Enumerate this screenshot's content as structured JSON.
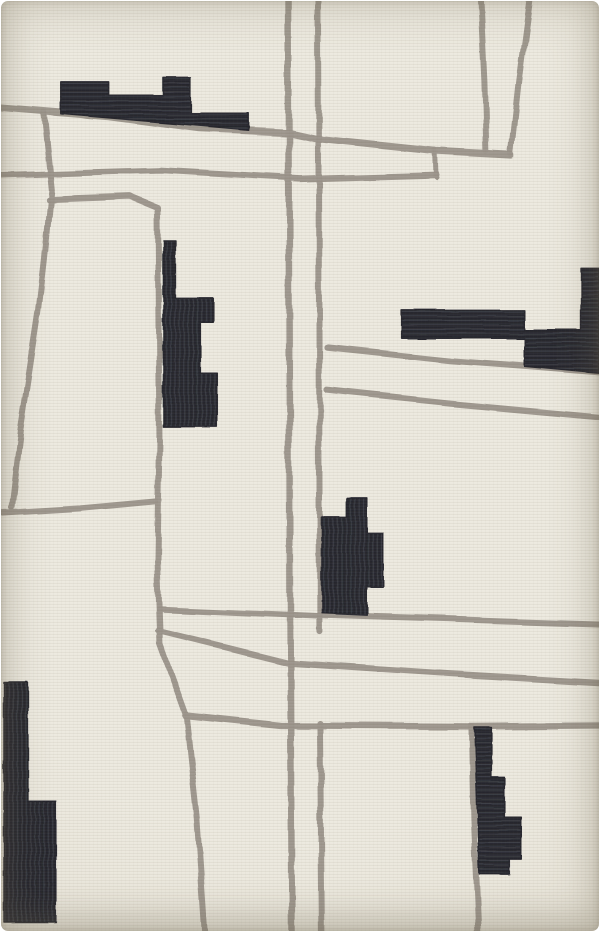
{
  "scene": {
    "type": "product-photo",
    "subject": "abstract geometric hand-tufted wool area rug",
    "style": "ivory ground crossed by hand-drawn taupe lines like an abstract street map, with charcoal stepped blocks",
    "orientation": "portrait"
  },
  "palette": {
    "page_bg": "#ffffff",
    "rug_base": "#eae7dd",
    "rug_edge": "#d5cfc0",
    "line_gray": "#9a938a",
    "block_black": "#23242b",
    "block_weave": "#363841"
  },
  "rug": {
    "lines": [
      {
        "name": "line-top-slant",
        "width": 7,
        "points": [
          [
            -3,
            107
          ],
          [
            108,
            116
          ],
          [
            200,
            128
          ],
          [
            290,
            132
          ],
          [
            322,
            139
          ],
          [
            437,
            151
          ],
          [
            512,
            155
          ]
        ]
      },
      {
        "name": "line-upper-horizontal",
        "width": 6,
        "points": [
          [
            -3,
            175
          ],
          [
            160,
            170
          ],
          [
            300,
            178
          ],
          [
            437,
            174
          ]
        ]
      },
      {
        "name": "line-upper-connector",
        "width": 5,
        "points": [
          [
            436,
            150
          ],
          [
            437,
            176
          ]
        ]
      },
      {
        "name": "line-funnel-left",
        "width": 6,
        "points": [
          [
            481,
            -3
          ],
          [
            485,
            80
          ],
          [
            487,
            151
          ]
        ]
      },
      {
        "name": "line-funnel-right",
        "width": 6,
        "points": [
          [
            531,
            -3
          ],
          [
            520,
            80
          ],
          [
            512,
            154
          ]
        ]
      },
      {
        "name": "line-center-vertical-a",
        "width": 6.5,
        "points": [
          [
            288,
            -3
          ],
          [
            289,
            300
          ],
          [
            290,
            620
          ],
          [
            292,
            935
          ]
        ]
      },
      {
        "name": "line-center-vertical-b-upper",
        "width": 6,
        "points": [
          [
            318,
            -3
          ],
          [
            319,
            300
          ],
          [
            320,
            632
          ]
        ]
      },
      {
        "name": "line-center-vertical-b-lower",
        "width": 6,
        "points": [
          [
            320,
            724
          ],
          [
            322,
            935
          ]
        ]
      },
      {
        "name": "line-left-diagonal",
        "width": 6,
        "points": [
          [
            43,
            112
          ],
          [
            51,
            190
          ],
          [
            44,
            260
          ],
          [
            38,
            312
          ],
          [
            20,
            430
          ],
          [
            11,
            508
          ]
        ]
      },
      {
        "name": "line-left-branch",
        "width": 6,
        "points": [
          [
            48,
            199
          ],
          [
            130,
            196
          ],
          [
            157,
            207
          ],
          [
            159,
            440
          ],
          [
            157,
            560
          ],
          [
            160,
            645
          ],
          [
            186,
            717
          ],
          [
            197,
            820
          ],
          [
            205,
            935
          ]
        ]
      },
      {
        "name": "line-left-horizontal",
        "width": 6,
        "points": [
          [
            -3,
            514
          ],
          [
            80,
            509
          ],
          [
            155,
            502
          ]
        ]
      },
      {
        "name": "line-right-slant-upper",
        "width": 6,
        "points": [
          [
            327,
            347
          ],
          [
            450,
            360
          ],
          [
            530,
            366
          ],
          [
            603,
            372
          ]
        ]
      },
      {
        "name": "line-right-slant-lower",
        "width": 6,
        "points": [
          [
            327,
            390
          ],
          [
            450,
            403
          ],
          [
            603,
            417
          ]
        ]
      },
      {
        "name": "line-lower-horizontal-1",
        "width": 6,
        "points": [
          [
            159,
            609
          ],
          [
            320,
            616
          ],
          [
            450,
            620
          ],
          [
            603,
            625
          ]
        ]
      },
      {
        "name": "line-lower-horizontal-2",
        "width": 6,
        "points": [
          [
            158,
            631
          ],
          [
            287,
            663
          ],
          [
            450,
            674
          ],
          [
            603,
            683
          ]
        ]
      },
      {
        "name": "line-lower-horizontal-3",
        "width": 6.5,
        "points": [
          [
            185,
            716
          ],
          [
            280,
            726
          ],
          [
            472,
            727
          ],
          [
            603,
            726
          ]
        ]
      },
      {
        "name": "line-bottom-right-vertical",
        "width": 6,
        "points": [
          [
            472,
            727
          ],
          [
            474,
            820
          ],
          [
            479,
            935
          ]
        ]
      }
    ],
    "blocks": [
      {
        "name": "block-top-left-skyline",
        "stitch": "h",
        "points": [
          [
            60,
            81
          ],
          [
            108,
            81
          ],
          [
            108,
            95
          ],
          [
            163,
            95
          ],
          [
            163,
            77
          ],
          [
            190,
            77
          ],
          [
            190,
            112
          ],
          [
            248,
            112
          ],
          [
            248,
            129
          ],
          [
            60,
            113
          ]
        ]
      },
      {
        "name": "block-left-stepped",
        "stitch": "v",
        "points": [
          [
            163,
            240
          ],
          [
            175,
            240
          ],
          [
            175,
            298
          ],
          [
            213,
            298
          ],
          [
            213,
            322
          ],
          [
            200,
            322
          ],
          [
            200,
            373
          ],
          [
            217,
            373
          ],
          [
            217,
            427
          ],
          [
            163,
            427
          ]
        ]
      },
      {
        "name": "block-right-span",
        "stitch": "h",
        "points": [
          [
            402,
            310
          ],
          [
            525,
            310
          ],
          [
            525,
            330
          ],
          [
            582,
            330
          ],
          [
            582,
            268
          ],
          [
            600,
            268
          ],
          [
            600,
            373
          ],
          [
            525,
            366
          ],
          [
            525,
            338
          ],
          [
            402,
            338
          ]
        ]
      },
      {
        "name": "block-center-column",
        "stitch": "v",
        "points": [
          [
            347,
            498
          ],
          [
            367,
            498
          ],
          [
            367,
            533
          ],
          [
            383,
            533
          ],
          [
            383,
            587
          ],
          [
            367,
            587
          ],
          [
            367,
            615
          ],
          [
            322,
            613
          ],
          [
            322,
            518
          ],
          [
            347,
            518
          ]
        ]
      },
      {
        "name": "block-bottom-left-corner",
        "stitch": "v",
        "points": [
          [
            3,
            683
          ],
          [
            27,
            683
          ],
          [
            27,
            802
          ],
          [
            55,
            802
          ],
          [
            55,
            923
          ],
          [
            3,
            923
          ]
        ]
      },
      {
        "name": "block-bottom-right-steps",
        "stitch": "h",
        "points": [
          [
            475,
            728
          ],
          [
            492,
            728
          ],
          [
            492,
            778
          ],
          [
            505,
            778
          ],
          [
            505,
            818
          ],
          [
            522,
            818
          ],
          [
            522,
            860
          ],
          [
            510,
            860
          ],
          [
            510,
            875
          ],
          [
            480,
            875
          ]
        ]
      }
    ]
  }
}
